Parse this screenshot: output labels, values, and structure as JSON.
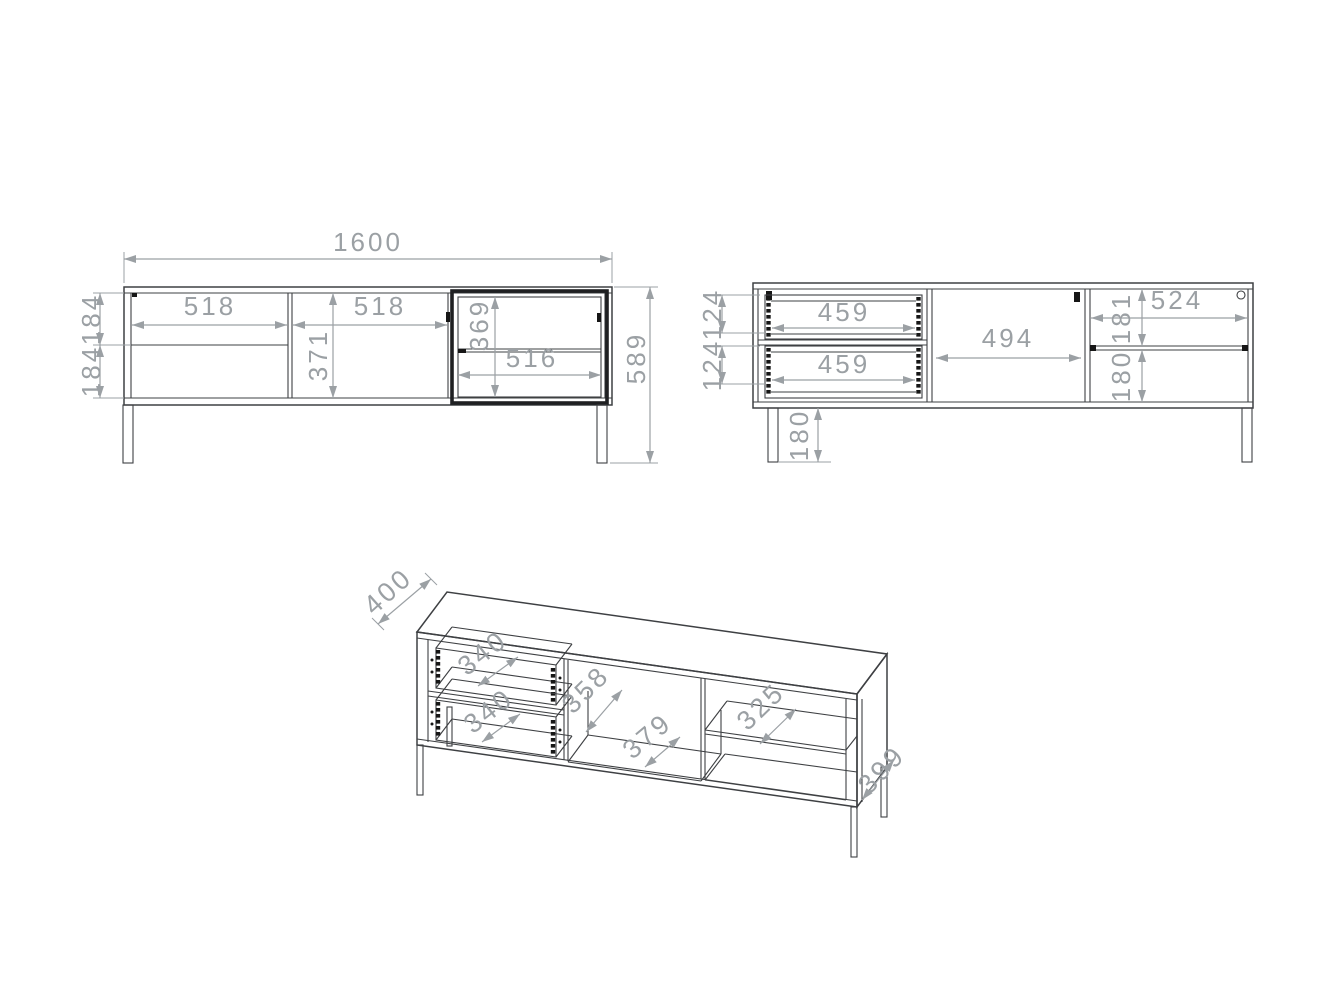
{
  "drawing": {
    "type": "furniture technical drawing - TV cabinet, three views",
    "colors": {
      "background": "#ffffff",
      "drawing_line": "#3e4043",
      "dimension": "#9ba0a4",
      "dark_frame": "#1f2022"
    },
    "views": {
      "front": {
        "dims": {
          "overall_width": "1600",
          "overall_height": "589",
          "left_section_width": "518",
          "middle_door_width": "518",
          "middle_door_height": "371",
          "top_drawer_height": "184",
          "bottom_drawer_height": "184",
          "glass_opening_height": "369",
          "glass_opening_width": "516"
        }
      },
      "internal": {
        "dims": {
          "top_drawer_width": "459",
          "bottom_drawer_width": "459",
          "top_drawer_height": "124",
          "bottom_drawer_height": "124",
          "middle_opening_width": "494",
          "right_section_width": "524",
          "right_top_opening_height": "181",
          "right_bottom_opening_height": "180",
          "leg_height": "180"
        }
      },
      "iso": {
        "dims": {
          "cabinet_depth": "400",
          "top_drawer_depth": "340",
          "bottom_drawer_depth": "340",
          "partition_depth": "358",
          "bottom_panel_depth": "379",
          "shelf_depth": "325",
          "side_panel_depth": "399"
        }
      }
    }
  }
}
